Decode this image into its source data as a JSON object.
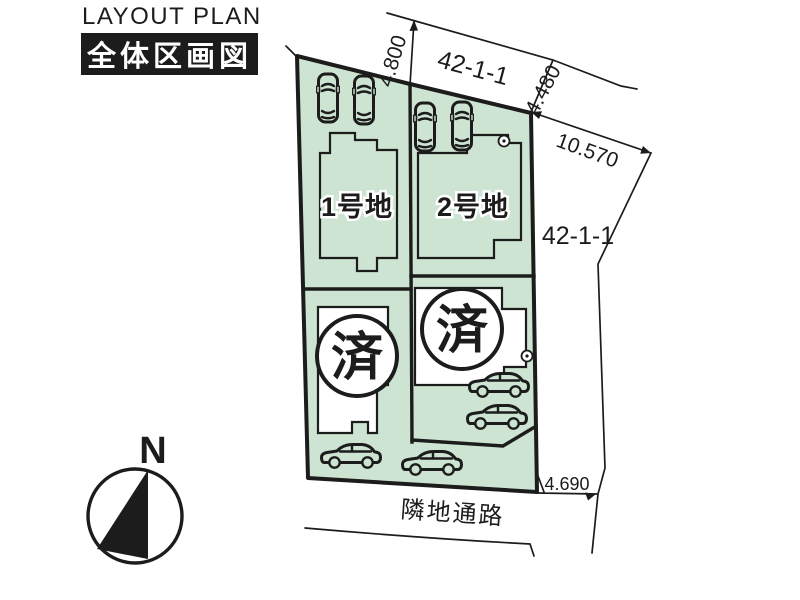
{
  "header": {
    "title_en": "LAYOUT PLAN",
    "title_ja": "全体区画図"
  },
  "compass": {
    "north_label": "N"
  },
  "site_plan": {
    "lots": [
      {
        "name": "1号地",
        "status": ""
      },
      {
        "name": "2号地",
        "status": ""
      },
      {
        "name": "",
        "status": "済"
      },
      {
        "name": "",
        "status": "済"
      }
    ],
    "parcel_number_top": "42-1-1",
    "parcel_number_east": "42-1-1",
    "road_label": "隣地通路",
    "dimensions": {
      "frontage_west": "4.800",
      "frontage_east": "4.480",
      "side_northeast": "10.570",
      "rear_south": "4.690"
    }
  },
  "colors": {
    "ink": "#1c1c1c",
    "lot_fill": "#cce4d1",
    "paper": "#ffffff"
  }
}
